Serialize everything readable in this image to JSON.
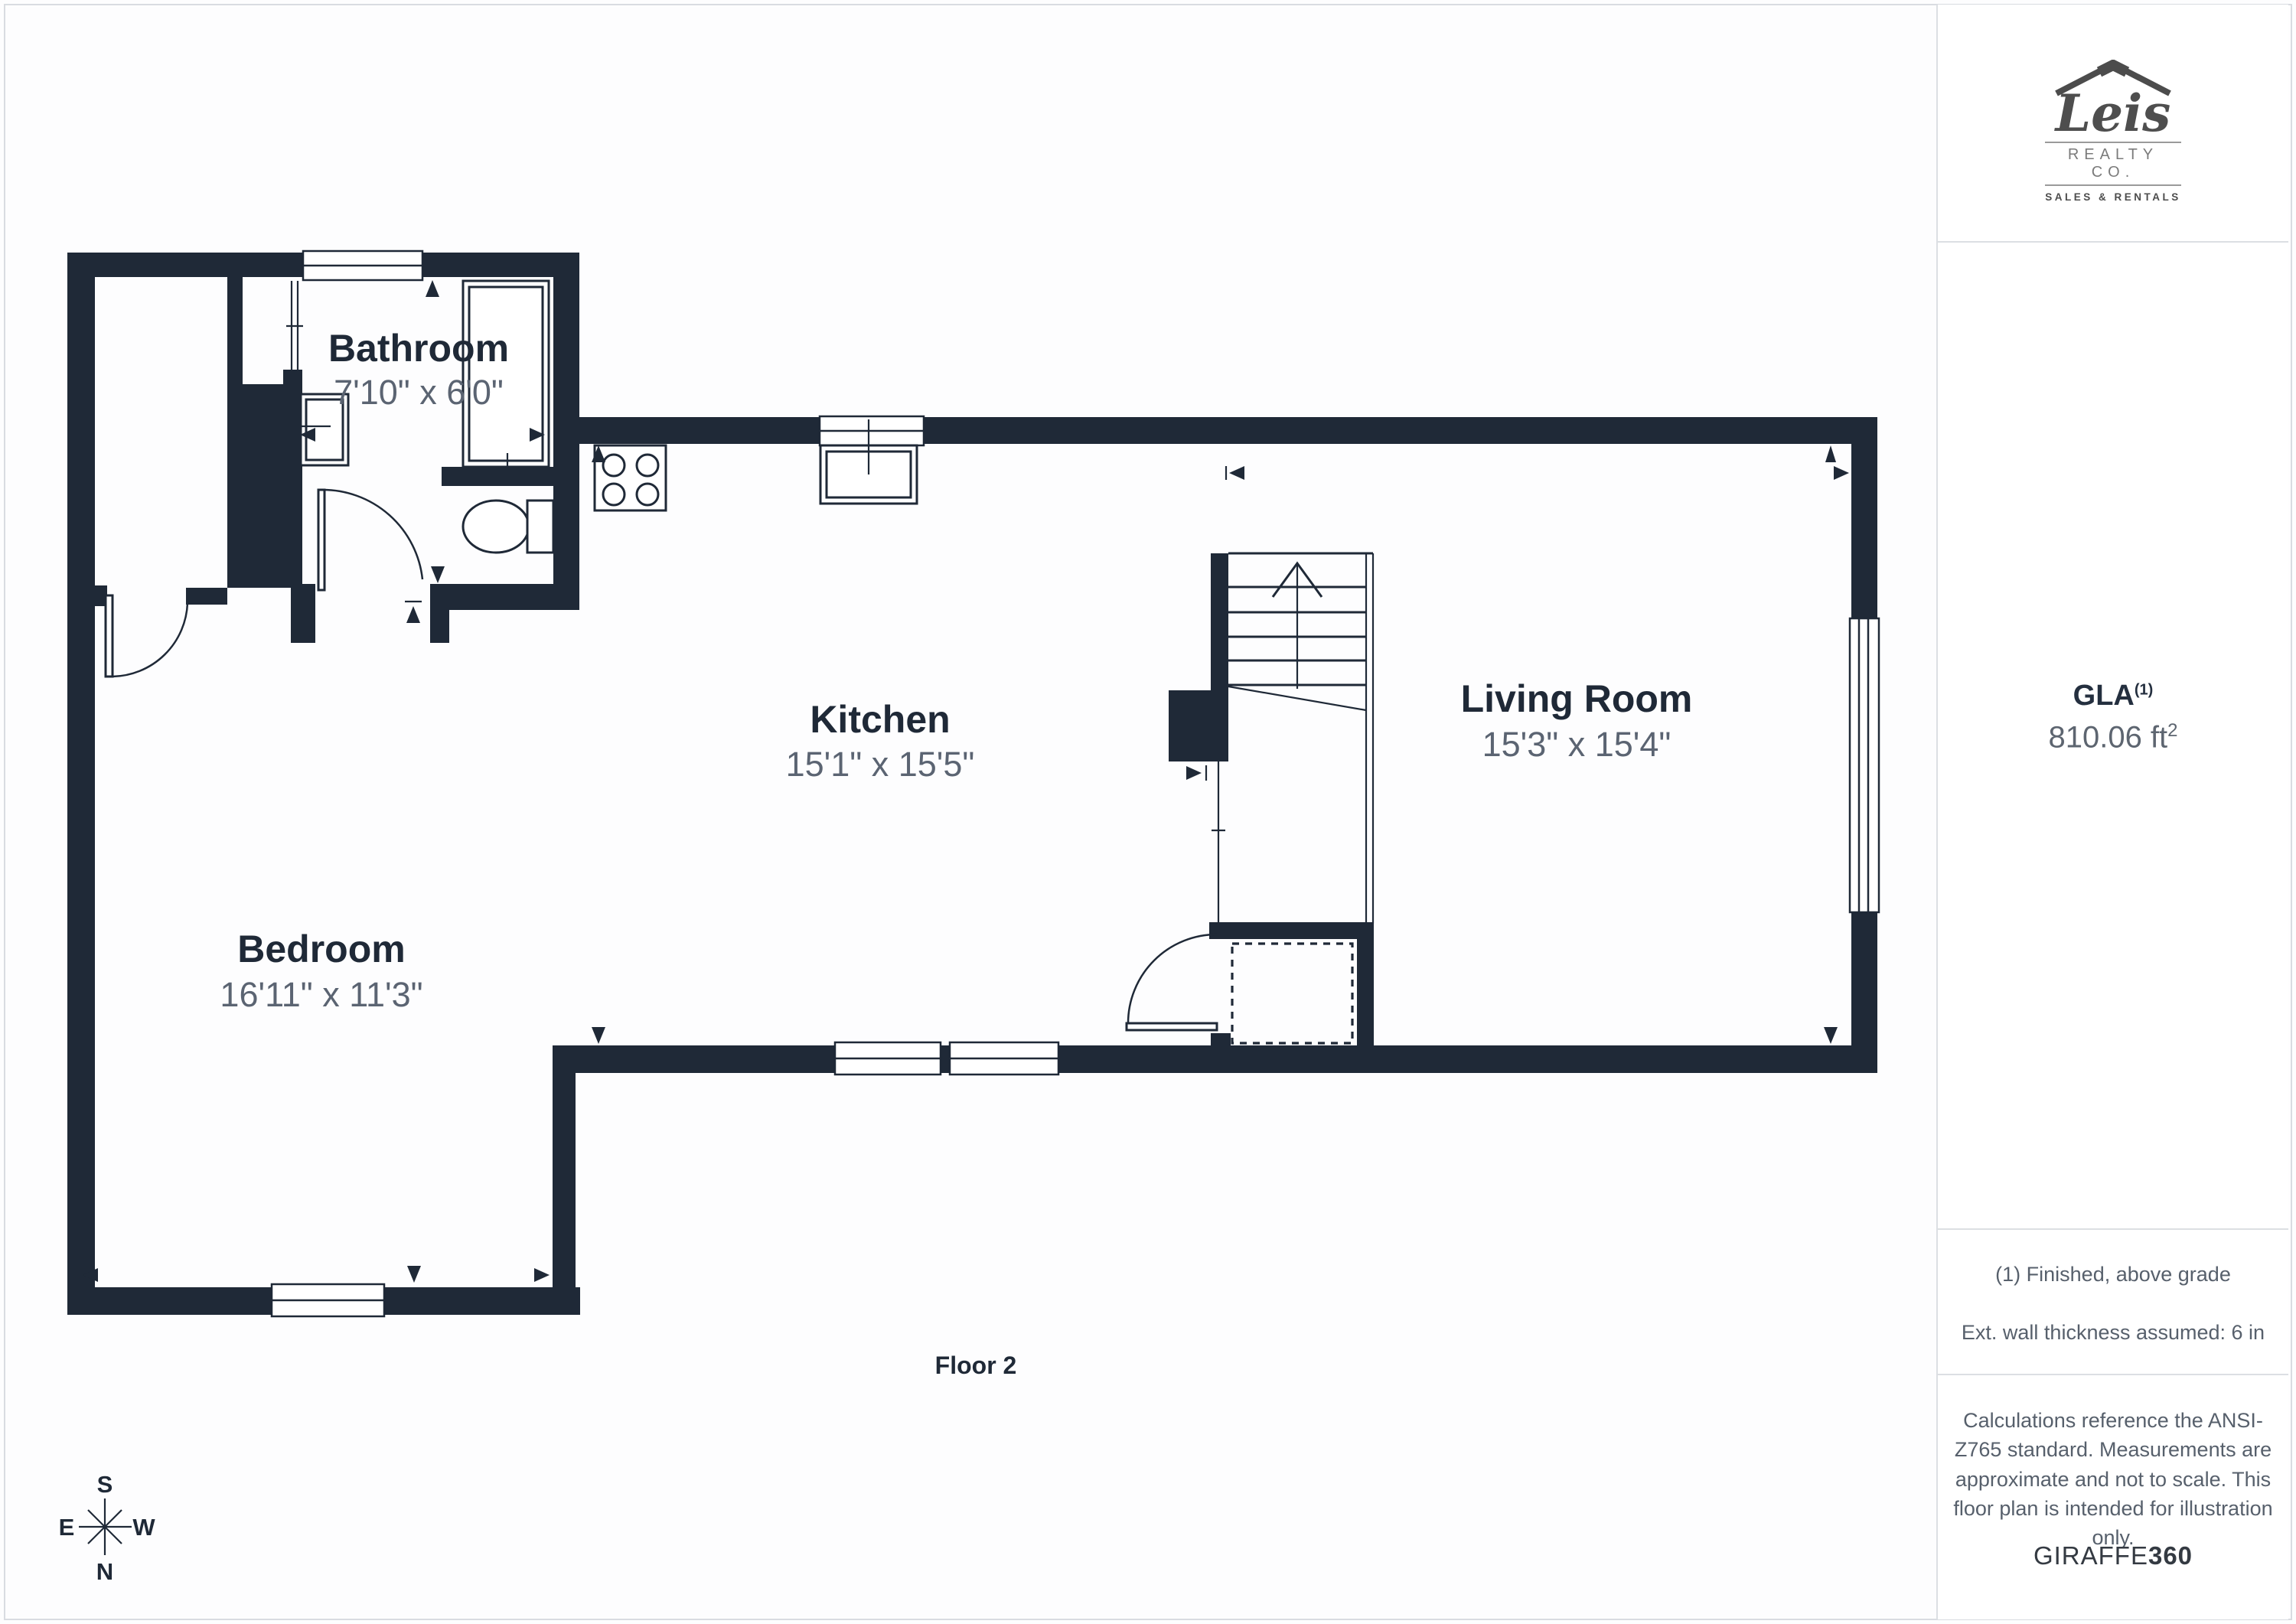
{
  "colors": {
    "wall": "#1f2937",
    "dim_text": "#5b6472",
    "divider": "#dcdfe3",
    "note_text": "#57606c"
  },
  "plan": {
    "floor_label": "Floor 2",
    "rooms": [
      {
        "name": "Bathroom",
        "dims": "7'10\" x 6'0\""
      },
      {
        "name": "Kitchen",
        "dims": "15'1\" x 15'5\""
      },
      {
        "name": "Living Room",
        "dims": "15'3\" x 15'4\""
      },
      {
        "name": "Bedroom",
        "dims": "16'11\" x 11'3\""
      }
    ],
    "compass": {
      "top": "S",
      "bottom": "N",
      "left": "E",
      "right": "W"
    }
  },
  "sidebar": {
    "logo": {
      "name": "Leis",
      "realty": "REALTY CO.",
      "tagline": "SALES & RENTALS"
    },
    "gla": {
      "label": "GLA",
      "footnote_ref": "(1)",
      "value": "810.06 ft",
      "unit_sup": "2"
    },
    "notes": {
      "finished": "(1) Finished, above grade",
      "wall_thickness": "Ext. wall thickness assumed: 6 in"
    },
    "disclaimer": "Calculations reference the ANSI-Z765 standard. Measurements are approximate and not to scale. This floor plan is intended for illustration only.",
    "brand": {
      "regular": "GIRAFFE",
      "bold": "360"
    }
  }
}
